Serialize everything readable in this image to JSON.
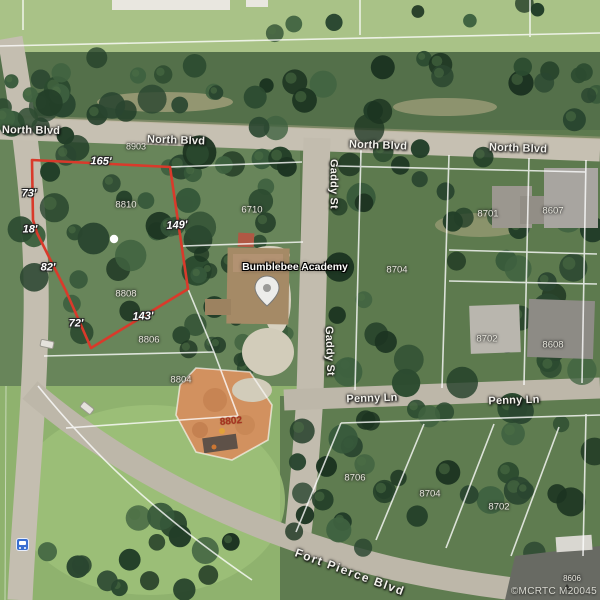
{
  "streets": {
    "north_blvd": "North Blvd",
    "gaddy_st": "Gaddy St",
    "penny_ln": "Penny Ln",
    "fort_pierce_blvd": "Fort Pierce Blvd"
  },
  "poi": {
    "school": "Bumblebee Academy"
  },
  "subject_parcel": {
    "dim_top": "165'",
    "dim_left_upper": "73'",
    "dim_left_mid": "18'",
    "dim_left_lower": "82'",
    "dim_bottom_left": "72'",
    "dim_bottom": "143'",
    "dim_right": "149'"
  },
  "parcels": {
    "p8903": "8903",
    "p8810": "8810",
    "p8808": "8808",
    "p8806": "8806",
    "p8804": "8804",
    "p8802": "8802",
    "p6710": "6710",
    "p8704_n": "8704",
    "p8701": "8701",
    "p8607": "8607",
    "p8702_e": "8702",
    "p8608": "8608",
    "p8706": "8706",
    "p8704_s": "8704",
    "p8702_s": "8702",
    "p8606": "8606"
  },
  "watermark": "©MCRTC M20045",
  "colors": {
    "subject_outline": "#d93a2b",
    "clearing": "#d2915f"
  }
}
